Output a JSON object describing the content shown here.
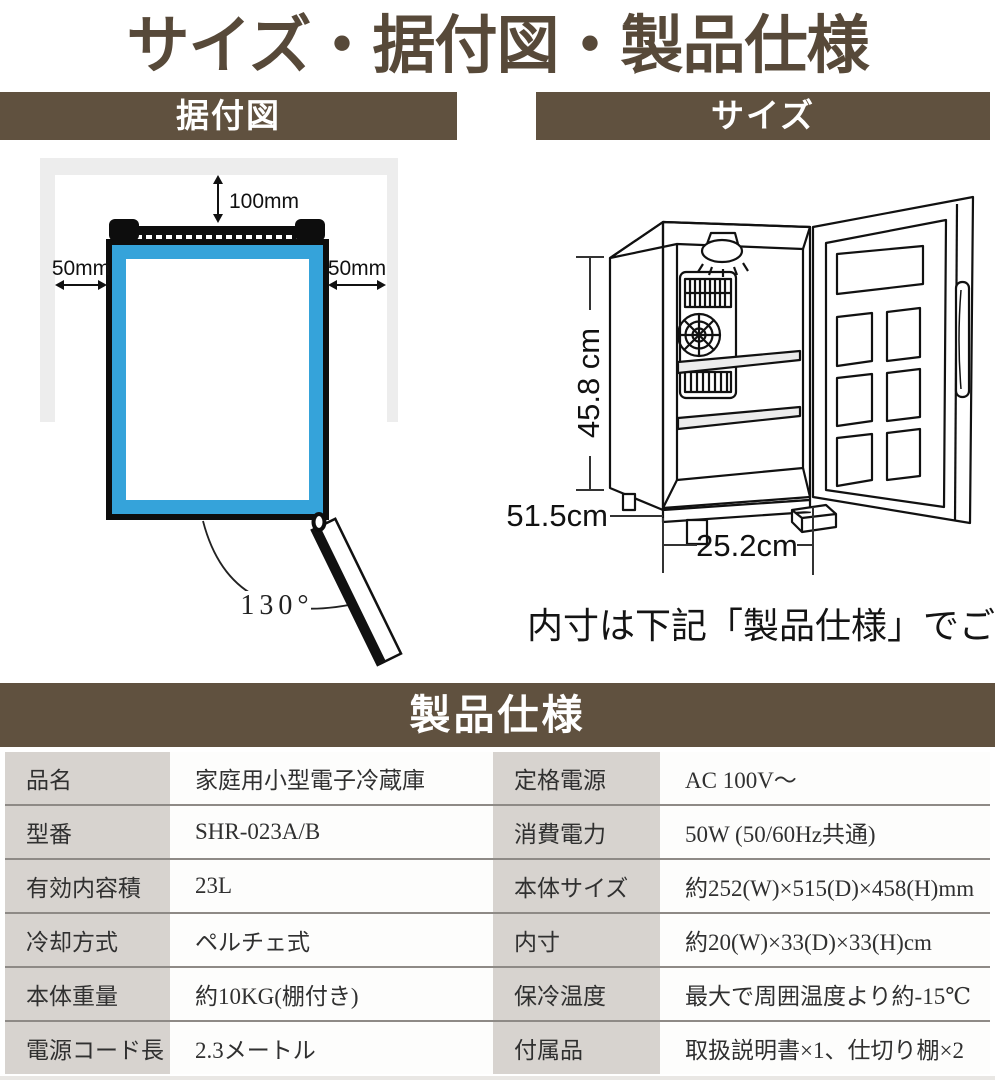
{
  "page": {
    "title": "サイズ・据付図・製品仕様"
  },
  "installation": {
    "header": "据付図",
    "clearance_top": "100mm",
    "clearance_left": "50mm",
    "clearance_right": "50mm",
    "door_open_angle": "130°"
  },
  "size_figure": {
    "header": "サイズ",
    "height_label": "45.8 cm",
    "depth_label": "51.5cm",
    "width_label": "25.2cm",
    "note": "内寸は下記「製品仕様」でご確認"
  },
  "specs": {
    "header": "製品仕様",
    "rows": [
      {
        "c0": "品名",
        "c1": "家庭用小型電子冷蔵庫",
        "c2": "定格電源",
        "c3": "AC 100V～"
      },
      {
        "c0": "型番",
        "c1": "SHR-023A/B",
        "c2": "消費電力",
        "c3": "50W (50/60Hz共通)"
      },
      {
        "c0": "有効内容積",
        "c1": "23L",
        "c2": "本体サイズ",
        "c3": "約252(W)×515(D)×458(H)mm"
      },
      {
        "c0": "冷却方式",
        "c1": "ペルチェ式",
        "c2": "内寸",
        "c3": "約20(W)×33(D)×33(H)cm"
      },
      {
        "c0": "本体重量",
        "c1": "約10KG(棚付き)",
        "c2": "保冷温度",
        "c3": "最大で周囲温度より約-15℃"
      },
      {
        "c0": "電源コード長",
        "c1": "2.3メートル",
        "c2": "付属品",
        "c3": "取扱説明書×1、仕切り棚×2"
      }
    ]
  },
  "colors": {
    "brand_brown": "#60513f",
    "title_brown": "#574939",
    "accent_blue": "#35a3da",
    "label_cell_bg": "#d7d3cf",
    "row_separator": "#8e8a86",
    "wall_gray": "#ededed"
  }
}
